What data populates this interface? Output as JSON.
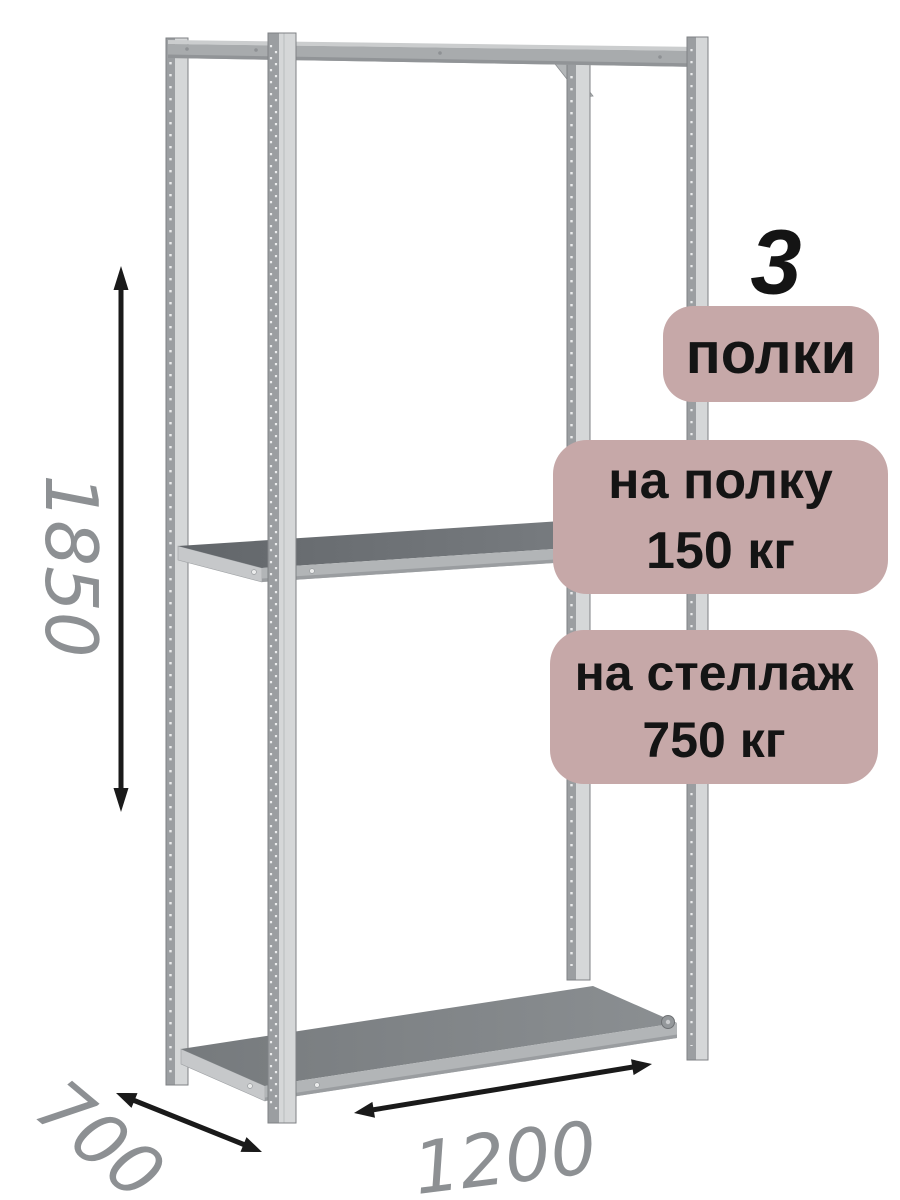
{
  "annotations": {
    "shelf_count": {
      "number": "3",
      "label": "полки"
    },
    "load_per_shelf": {
      "line1": "на полку",
      "line2": "150 кг"
    },
    "load_per_rack": {
      "line1": "на стеллаж",
      "line2": "750 кг"
    }
  },
  "dimensions": {
    "height": "1850",
    "depth": "700",
    "width": "1200"
  },
  "colors": {
    "background": "#ffffff",
    "badge_background": "#c6a8a8",
    "badge_text": "#141414",
    "dimension_text": "#8d9093",
    "arrow": "#1a1a1a",
    "metal_light": "#d5d7d8",
    "metal_dark": "#9b9ea1",
    "shelf_top": "#6f7377"
  },
  "illustration": {
    "subject": "metal-shelving-rack",
    "shelf_count": 3,
    "post_count": 4
  }
}
